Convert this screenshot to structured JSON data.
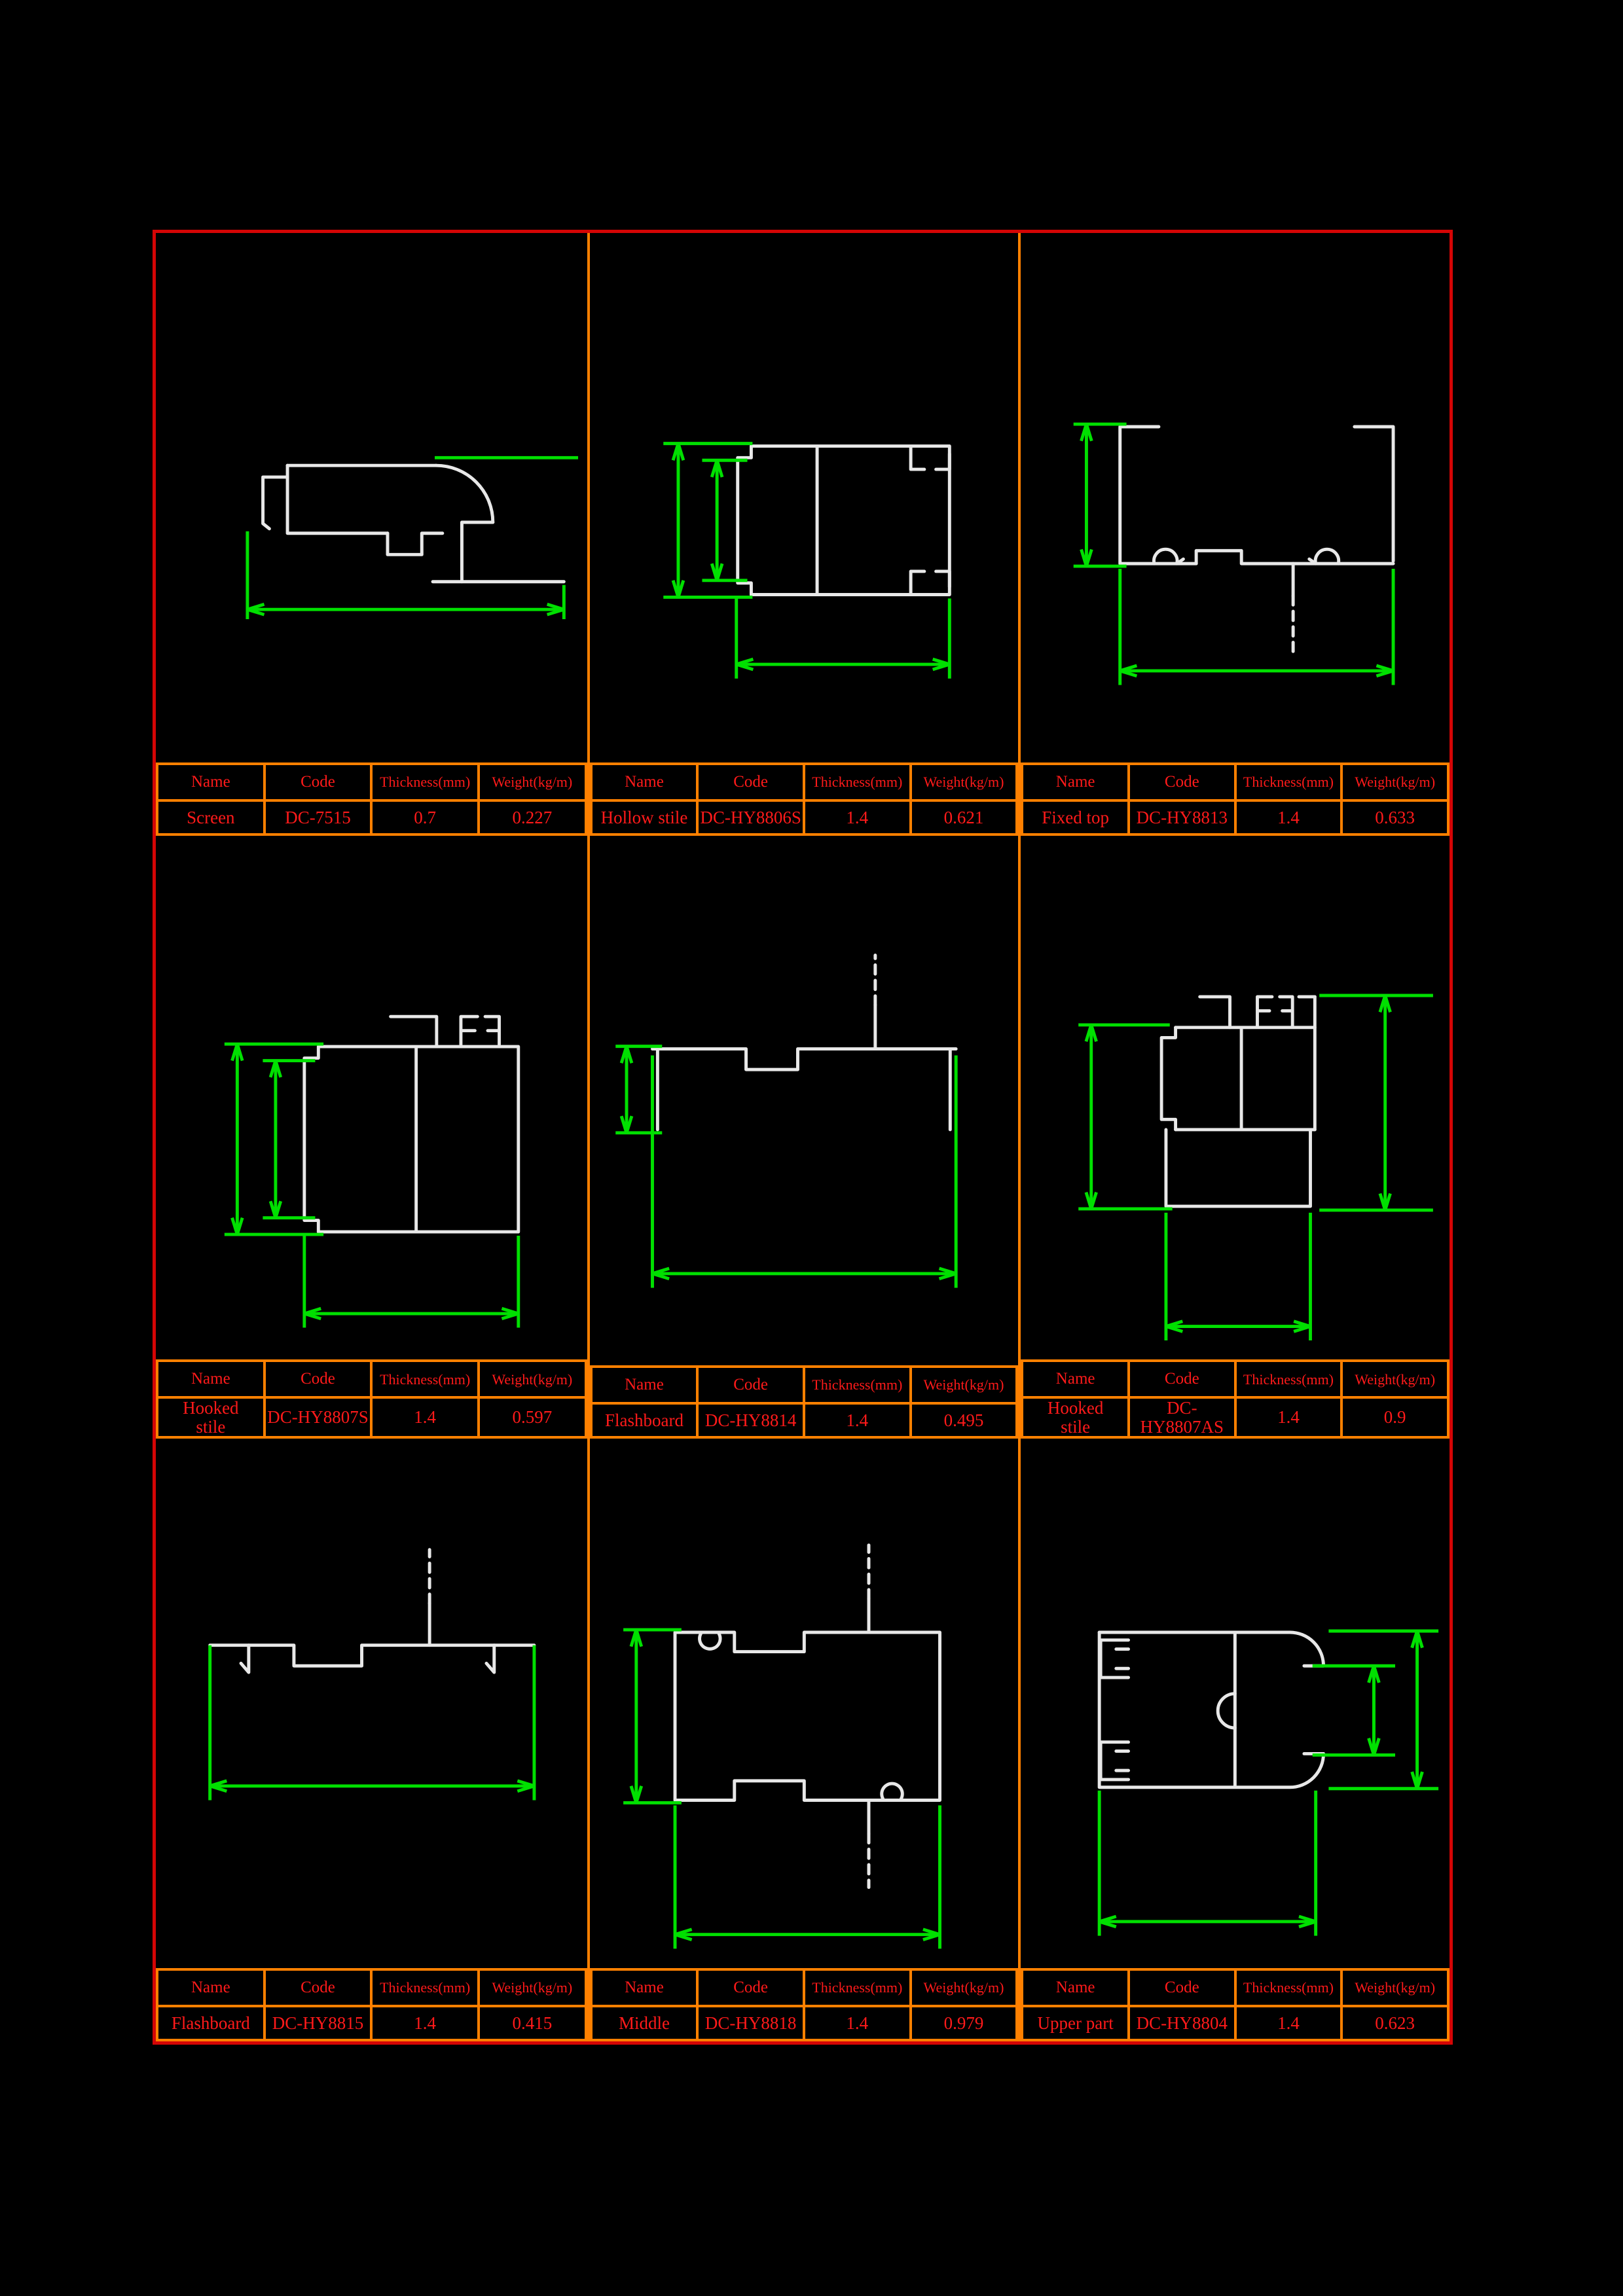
{
  "sheet": {
    "background": "#000000",
    "frame_color": "#d40505",
    "grid_color": "#ff8000",
    "text_color": "#ff1a1a",
    "dimension_color": "#00e000",
    "profile_color": "#e8e8e8"
  },
  "table_headers": {
    "name": "Name",
    "code": "Code",
    "thickness": "Thickness(mm)",
    "weight": "Weight(kg/m)"
  },
  "sections": [
    {
      "name": "Screen",
      "code": "DC-7515",
      "thickness": "0.7",
      "weight": "0.227"
    },
    {
      "name": "Hollow stile",
      "code": "DC-HY8806S",
      "thickness": "1.4",
      "weight": "0.621"
    },
    {
      "name": "Fixed top",
      "code": "DC-HY8813",
      "thickness": "1.4",
      "weight": "0.633"
    },
    {
      "name": "Hooked\nstile",
      "code": "DC-HY8807S",
      "thickness": "1.4",
      "weight": "0.597"
    },
    {
      "name": "Flashboard",
      "code": "DC-HY8814",
      "thickness": "1.4",
      "weight": "0.495"
    },
    {
      "name": "Hooked\nstile",
      "code": "DC-HY8807AS",
      "thickness": "1.4",
      "weight": "0.9"
    },
    {
      "name": "Flashboard",
      "code": "DC-HY8815",
      "thickness": "1.4",
      "weight": "0.415"
    },
    {
      "name": "Middle",
      "code": "DC-HY8818",
      "thickness": "1.4",
      "weight": "0.979"
    },
    {
      "name": "Upper part",
      "code": "DC-HY8804",
      "thickness": "1.4",
      "weight": "0.623"
    }
  ]
}
